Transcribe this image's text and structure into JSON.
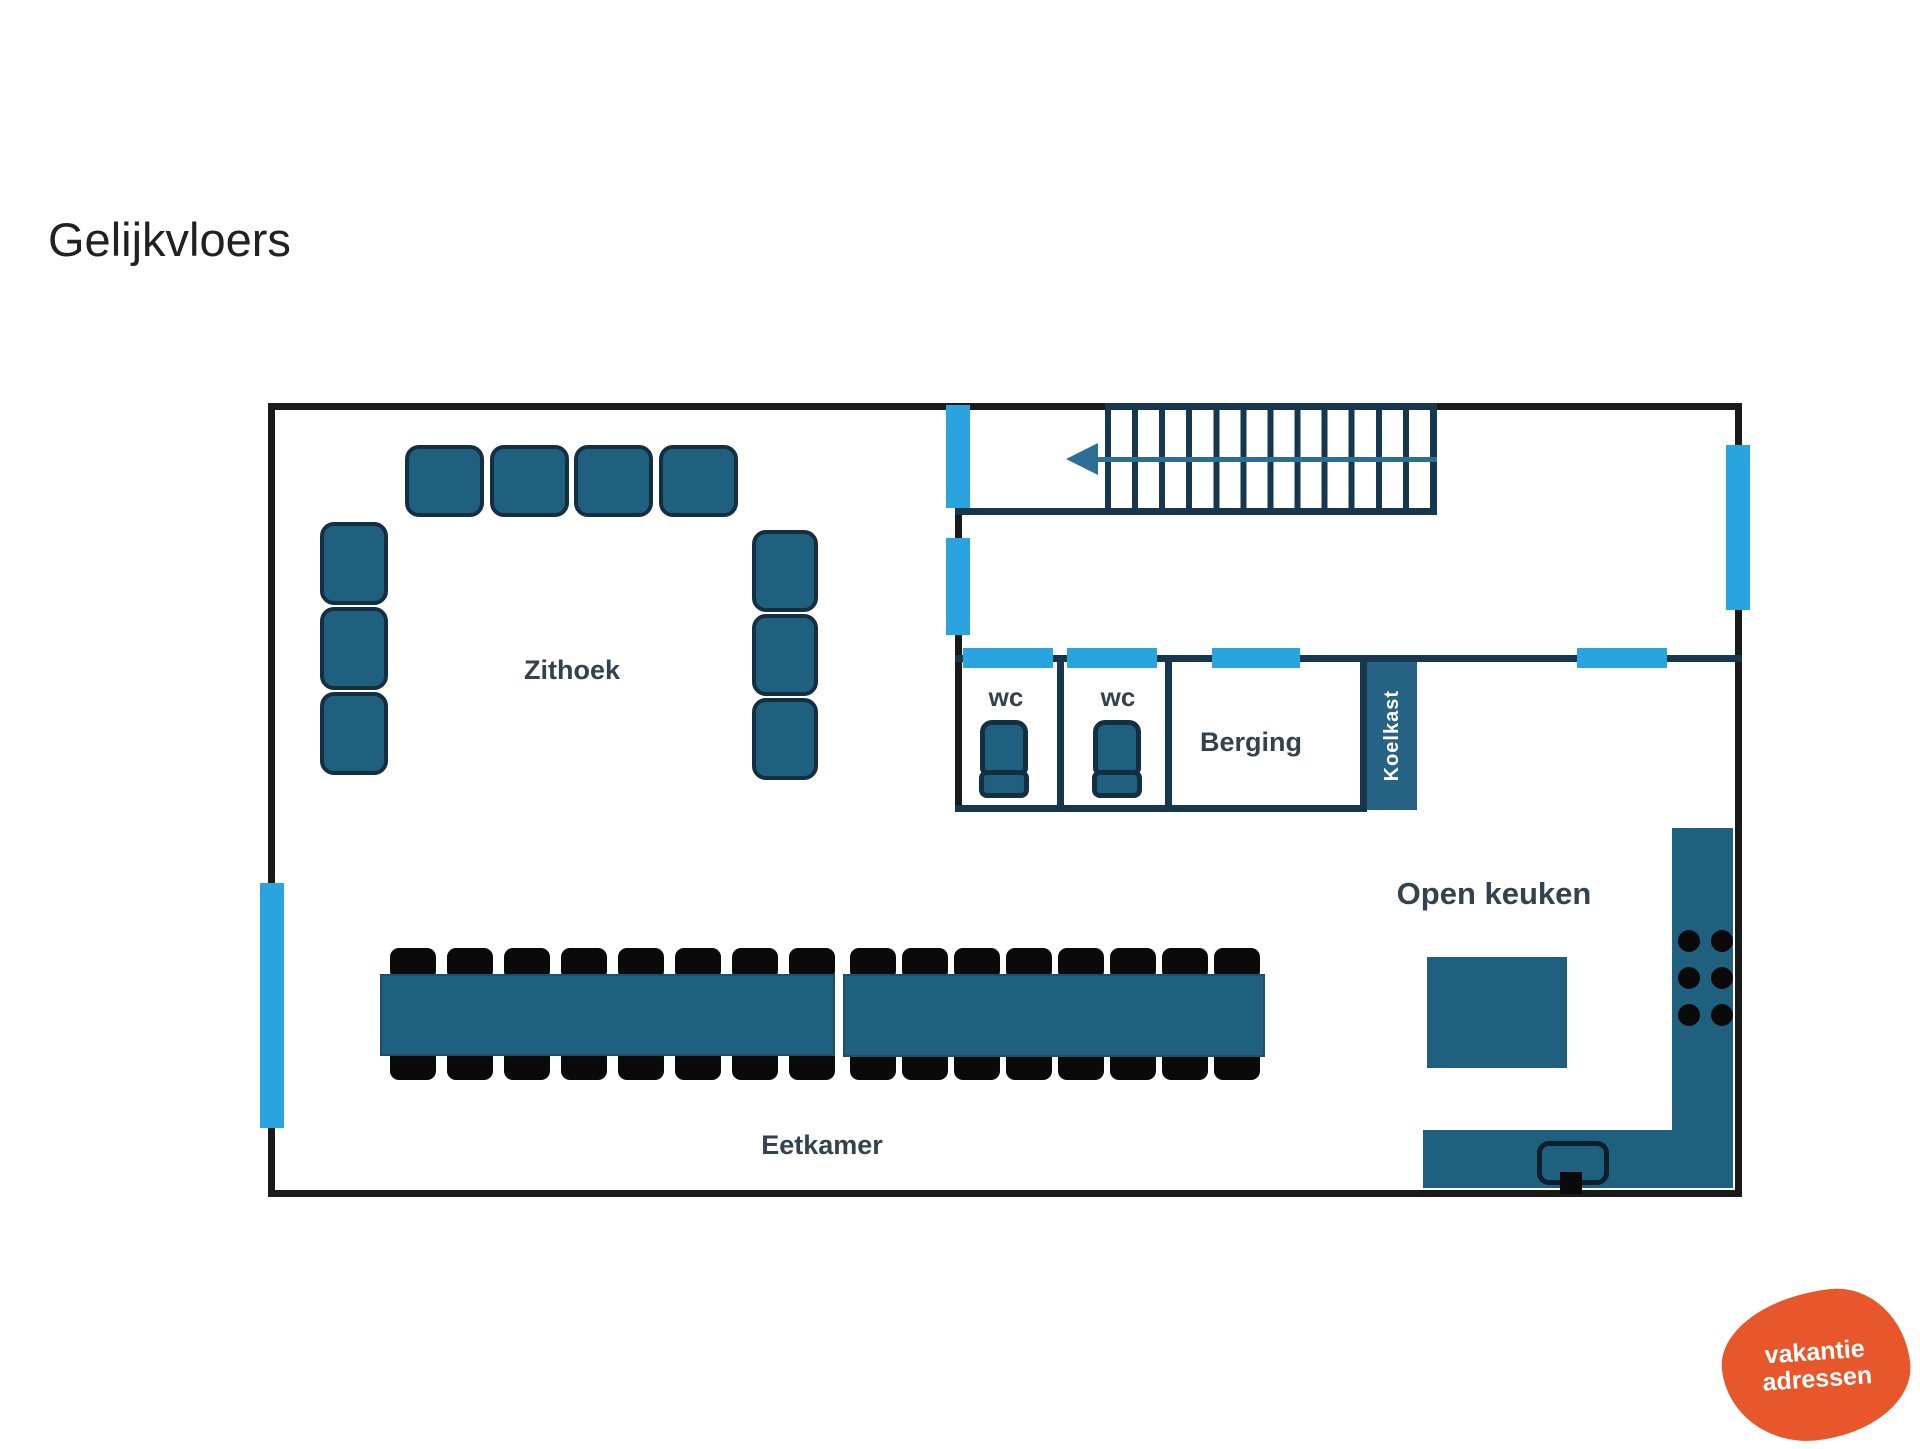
{
  "title": "Gelijkvloers",
  "labels": {
    "zithoek": "Zithoek",
    "eetkamer": "Eetkamer",
    "open_keuken": "Open keuken",
    "berging": "Berging",
    "wc_left": "wc",
    "wc_right": "wc",
    "koelkast": "Koelkast"
  },
  "logo": {
    "line1": "vakantie",
    "line2": "adressen",
    "background": "#e8562b",
    "text_color": "#ffffff"
  },
  "colors": {
    "outer_wall": "#1a1a1a",
    "inner_wall": "#16374e",
    "furniture": "#20607f",
    "furniture_stroke": "#152f42",
    "chair": "#0a0a0a",
    "door_window": "#29a4de",
    "label_text": "#33424f",
    "stair_arrow": "#2d6f94"
  },
  "furniture_counts": {
    "sofa_top_cushions": 4,
    "sofa_left_cushions": 3,
    "sofa_right_cushions": 3,
    "dining_tables": 2,
    "chairs_per_table_side": 8,
    "stair_treads": 12,
    "stove_burners": 6,
    "toilets": 2
  }
}
